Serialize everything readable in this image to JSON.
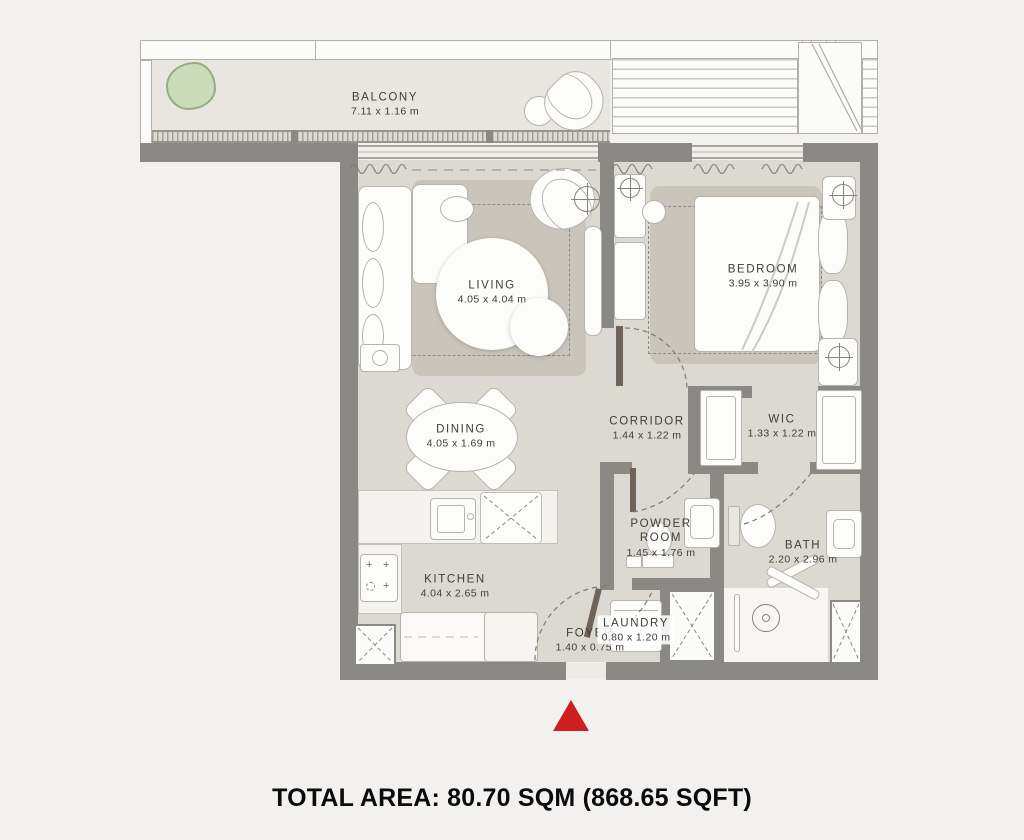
{
  "footer": {
    "total_area": "TOTAL AREA: 80.70 SQM (868.65 SQFT)"
  },
  "rooms": {
    "balcony": {
      "name": "BALCONY",
      "dims": "7.11 x 1.16 m"
    },
    "living": {
      "name": "LIVING",
      "dims": "4.05 x 4.04 m"
    },
    "bedroom": {
      "name": "BEDROOM",
      "dims": "3.95 x 3.90 m"
    },
    "dining": {
      "name": "DINING",
      "dims": "4.05 x 1.69 m"
    },
    "corridor": {
      "name": "CORRIDOR",
      "dims": "1.44 x 1.22 m"
    },
    "wic": {
      "name": "WIC",
      "dims": "1.33 x 1.22 m"
    },
    "powder_room": {
      "name": "POWDER ROOM",
      "dims": "1.45 x 1.76 m"
    },
    "bath": {
      "name": "BATH",
      "dims": "2.20 x 2.96 m"
    },
    "kitchen": {
      "name": "KITCHEN",
      "dims": "4.04 x 2.65 m"
    },
    "foyer": {
      "name": "FOYER",
      "dims": "1.40 x 0.75 m"
    },
    "laundry": {
      "name": "LAUNDRY",
      "dims": "0.80 x 1.20 m"
    }
  },
  "colors": {
    "background": "#f2f1ef",
    "wall": "#8b8985",
    "floor": "#dcd9d2",
    "balcony_floor": "#e9e6e1",
    "rug": "#c9c5bb",
    "entrance_marker": "#ce1e1e",
    "plant": "#cbdcba"
  }
}
